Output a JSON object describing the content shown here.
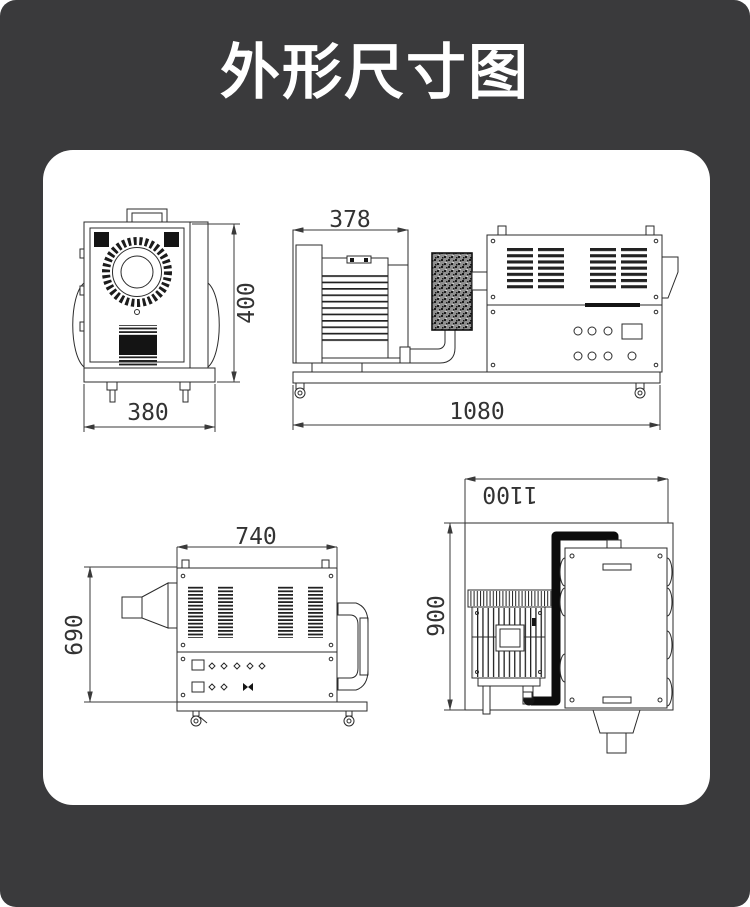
{
  "page": {
    "title": "外形尺寸图",
    "background_color": "#3a3a3c",
    "panel_color": "#ffffff",
    "line_color": "#2b2b2b"
  },
  "dims": {
    "front_height": "400",
    "front_width": "380",
    "side_width": "378",
    "side_length": "1080",
    "left_width": "740",
    "left_height": "690",
    "top_length": "1100",
    "top_depth": "900"
  }
}
